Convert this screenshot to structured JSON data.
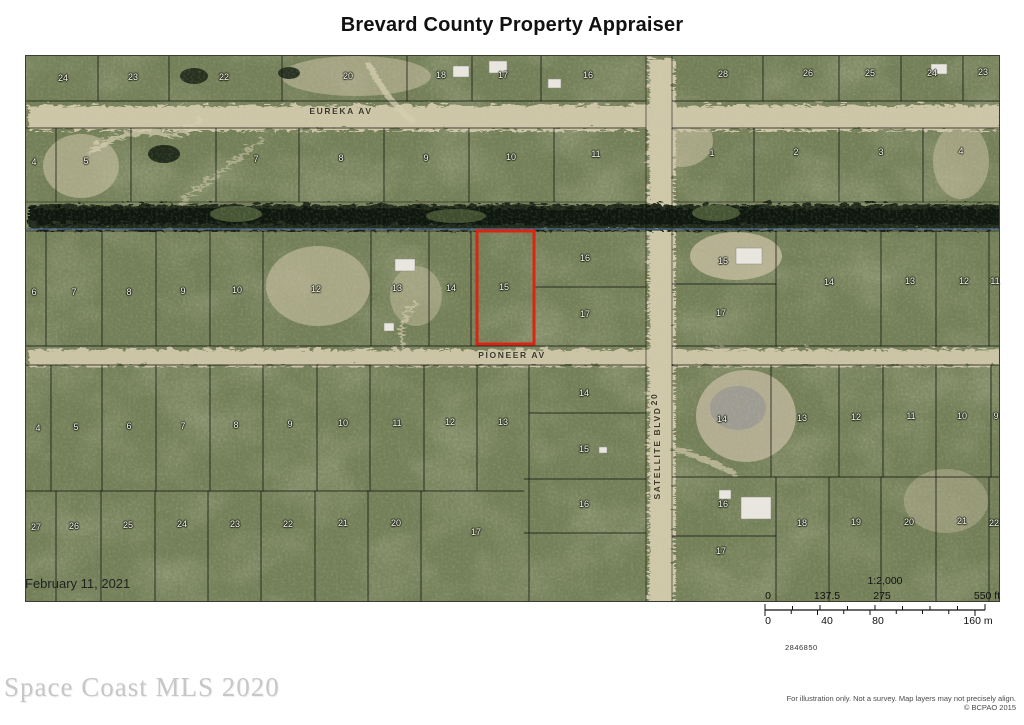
{
  "title": "Brevard County Property Appraiser",
  "date_label": "February 11, 2021",
  "watermark": "Space Coast MLS 2020",
  "map_number": "2846850",
  "disclaimer_line1": "For illustration only. Not a survey. Map layers may not precisely align.",
  "disclaimer_line2": "© BCPAO 2015",
  "scale": {
    "ratio": "1:2,000",
    "ft_ticks": [
      {
        "label": "0",
        "x": 8
      },
      {
        "label": "137.5",
        "x": 67
      },
      {
        "label": "275",
        "x": 122
      },
      {
        "label": "550 ft",
        "x": 227
      }
    ],
    "m_ticks": [
      {
        "label": "0",
        "x": 8
      },
      {
        "label": "40",
        "x": 67
      },
      {
        "label": "80",
        "x": 118
      },
      {
        "label": "160 m",
        "x": 218
      }
    ]
  },
  "map": {
    "highlight": {
      "parcel": "15",
      "color": "#dd2413"
    },
    "streets": [
      {
        "label": "EUREKA AV",
        "x": 315,
        "y": 55,
        "rot": false
      },
      {
        "label": "PIONEER AV",
        "x": 486,
        "y": 299,
        "rot": false
      },
      {
        "label": "SATELLITE BLVD",
        "x": 631,
        "y": 397,
        "rot": true
      },
      {
        "label": "20",
        "x": 628,
        "y": 343,
        "rot": true
      }
    ],
    "parcels": [
      {
        "n": "24",
        "x": 37,
        "y": 22
      },
      {
        "n": "23",
        "x": 107,
        "y": 21
      },
      {
        "n": "22",
        "x": 198,
        "y": 21
      },
      {
        "n": "20",
        "x": 322,
        "y": 20
      },
      {
        "n": "18",
        "x": 415,
        "y": 19
      },
      {
        "n": "17",
        "x": 477,
        "y": 19
      },
      {
        "n": "16",
        "x": 562,
        "y": 19
      },
      {
        "n": "28",
        "x": 697,
        "y": 18
      },
      {
        "n": "26",
        "x": 782,
        "y": 17
      },
      {
        "n": "25",
        "x": 844,
        "y": 17
      },
      {
        "n": "24",
        "x": 906,
        "y": 17
      },
      {
        "n": "23",
        "x": 957,
        "y": 16
      },
      {
        "n": "4",
        "x": 8,
        "y": 106
      },
      {
        "n": "5",
        "x": 60,
        "y": 105
      },
      {
        "n": "7",
        "x": 230,
        "y": 103
      },
      {
        "n": "8",
        "x": 315,
        "y": 102
      },
      {
        "n": "9",
        "x": 400,
        "y": 102
      },
      {
        "n": "10",
        "x": 485,
        "y": 101
      },
      {
        "n": "11",
        "x": 570,
        "y": 98
      },
      {
        "n": "1",
        "x": 686,
        "y": 97
      },
      {
        "n": "2",
        "x": 770,
        "y": 96
      },
      {
        "n": "3",
        "x": 855,
        "y": 96
      },
      {
        "n": "4",
        "x": 935,
        "y": 95
      },
      {
        "n": "6",
        "x": 8,
        "y": 236
      },
      {
        "n": "7",
        "x": 48,
        "y": 236
      },
      {
        "n": "8",
        "x": 103,
        "y": 236
      },
      {
        "n": "9",
        "x": 157,
        "y": 235
      },
      {
        "n": "10",
        "x": 211,
        "y": 234
      },
      {
        "n": "12",
        "x": 290,
        "y": 233
      },
      {
        "n": "13",
        "x": 371,
        "y": 232
      },
      {
        "n": "14",
        "x": 425,
        "y": 232
      },
      {
        "n": "15",
        "x": 478,
        "y": 231
      },
      {
        "n": "16",
        "x": 559,
        "y": 202
      },
      {
        "n": "17",
        "x": 559,
        "y": 258
      },
      {
        "n": "15",
        "x": 697,
        "y": 205
      },
      {
        "n": "17",
        "x": 695,
        "y": 257
      },
      {
        "n": "14",
        "x": 803,
        "y": 226
      },
      {
        "n": "13",
        "x": 884,
        "y": 225
      },
      {
        "n": "12",
        "x": 938,
        "y": 225
      },
      {
        "n": "11",
        "x": 969,
        "y": 225
      },
      {
        "n": "4",
        "x": 12,
        "y": 372
      },
      {
        "n": "5",
        "x": 50,
        "y": 371
      },
      {
        "n": "6",
        "x": 103,
        "y": 370
      },
      {
        "n": "7",
        "x": 157,
        "y": 370
      },
      {
        "n": "8",
        "x": 210,
        "y": 369
      },
      {
        "n": "9",
        "x": 264,
        "y": 368
      },
      {
        "n": "10",
        "x": 317,
        "y": 367
      },
      {
        "n": "11",
        "x": 371,
        "y": 367
      },
      {
        "n": "12",
        "x": 424,
        "y": 366
      },
      {
        "n": "13",
        "x": 477,
        "y": 366
      },
      {
        "n": "14",
        "x": 558,
        "y": 337
      },
      {
        "n": "15",
        "x": 558,
        "y": 393
      },
      {
        "n": "16",
        "x": 558,
        "y": 448
      },
      {
        "n": "14",
        "x": 696,
        "y": 363
      },
      {
        "n": "13",
        "x": 776,
        "y": 362
      },
      {
        "n": "12",
        "x": 830,
        "y": 361
      },
      {
        "n": "11",
        "x": 885,
        "y": 360
      },
      {
        "n": "10",
        "x": 936,
        "y": 360
      },
      {
        "n": "9",
        "x": 970,
        "y": 360
      },
      {
        "n": "27",
        "x": 10,
        "y": 471
      },
      {
        "n": "26",
        "x": 48,
        "y": 470
      },
      {
        "n": "25",
        "x": 102,
        "y": 469
      },
      {
        "n": "24",
        "x": 156,
        "y": 468
      },
      {
        "n": "23",
        "x": 209,
        "y": 468
      },
      {
        "n": "22",
        "x": 262,
        "y": 468
      },
      {
        "n": "21",
        "x": 317,
        "y": 467
      },
      {
        "n": "20",
        "x": 370,
        "y": 467
      },
      {
        "n": "17",
        "x": 450,
        "y": 476
      },
      {
        "n": "16",
        "x": 697,
        "y": 448
      },
      {
        "n": "17",
        "x": 695,
        "y": 495
      },
      {
        "n": "18",
        "x": 776,
        "y": 467
      },
      {
        "n": "19",
        "x": 830,
        "y": 466
      },
      {
        "n": "20",
        "x": 883,
        "y": 466
      },
      {
        "n": "21",
        "x": 936,
        "y": 465
      },
      {
        "n": "22",
        "x": 968,
        "y": 467
      }
    ]
  }
}
